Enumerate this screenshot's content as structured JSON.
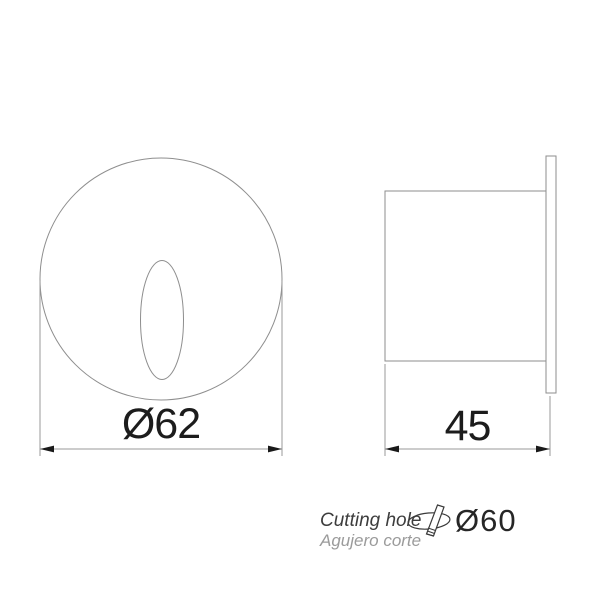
{
  "front_view": {
    "dimension_label": "Ø62"
  },
  "side_view": {
    "dimension_label": "45"
  },
  "cutting_hole_note": {
    "label_en": "Cutting hole",
    "label_es": "Agujero corte",
    "diameter_label": "Ø60"
  },
  "icons": {
    "cutting_tool": "hole-cutting-tool-icon"
  },
  "colors": {
    "background": "#ffffff",
    "drawing_line": "#8e8e8e",
    "dimension_line": "#9a9a9a",
    "dimension_arrow": "#1a1a1a",
    "dimension_text": "#1c1c1c",
    "note_primary": "#3d3d3d",
    "note_secondary": "#9b9b9b"
  }
}
